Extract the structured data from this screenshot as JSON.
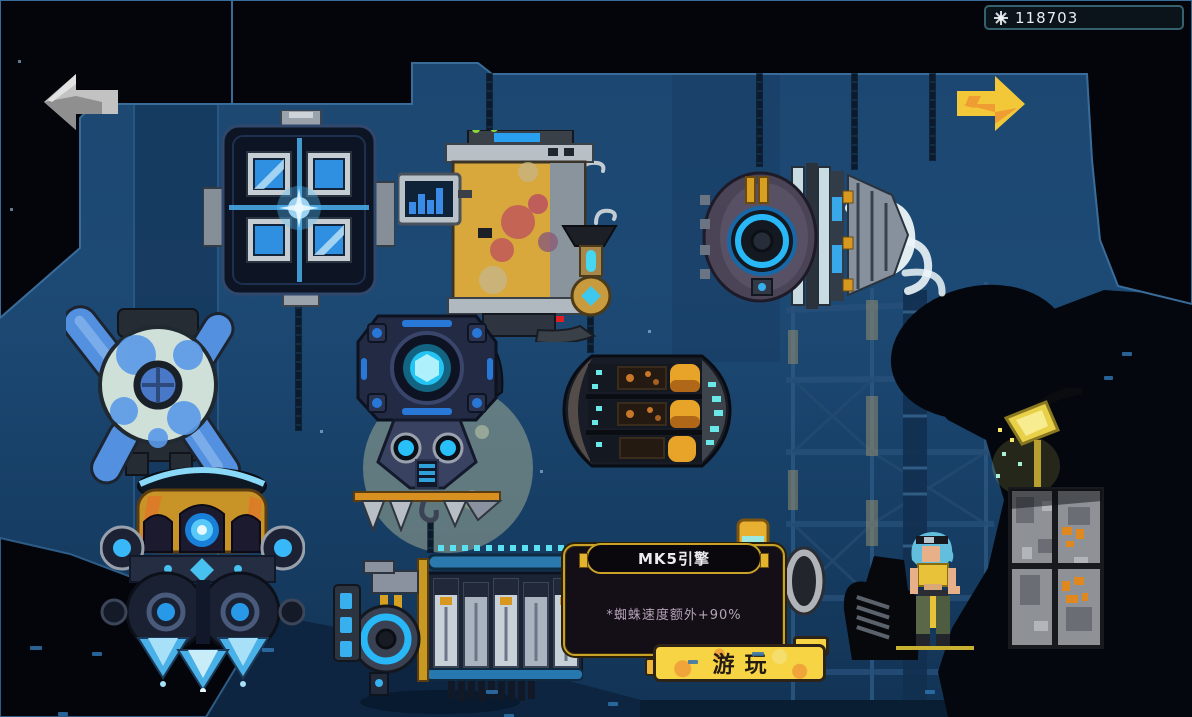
{
  "hud": {
    "currency": {
      "icon_name": "gear-burst-icon",
      "value": "118703"
    }
  },
  "navigation": {
    "prev_arrow": {
      "direction": "left",
      "state": "disabled",
      "color": "#bdbdbd"
    },
    "next_arrow": {
      "direction": "right",
      "state": "enabled",
      "color": "#f2c838"
    }
  },
  "tooltip": {
    "title": "MK5引擎",
    "body": "*蜘蛛速度额外+90%"
  },
  "play_button": {
    "label": "游玩"
  },
  "machines": [
    {
      "id": "quad-window-reactor"
    },
    {
      "id": "rusty-boiler-tank"
    },
    {
      "id": "turbine-engine"
    },
    {
      "id": "blue-propeller-unit"
    },
    {
      "id": "core-drill-unit"
    },
    {
      "id": "torpedo-pod"
    },
    {
      "id": "triple-thruster-pod"
    },
    {
      "id": "mk5-piston-engine"
    }
  ],
  "scene": {
    "character": "mechanic-girl",
    "props": [
      "hanging-chains",
      "scaffold-truss",
      "wall-spotlight",
      "cargo-crate",
      "moon-backdrop"
    ]
  },
  "colors": {
    "background_blue": "#1c4672",
    "ceiling_black": "#04060b",
    "gold_accent": "#c9a227",
    "glow_blue": "#38c8ff",
    "button_yellow": "#f6d443",
    "arrow_yellow": "#f2c838",
    "arrow_gray": "#bdbdbd"
  }
}
